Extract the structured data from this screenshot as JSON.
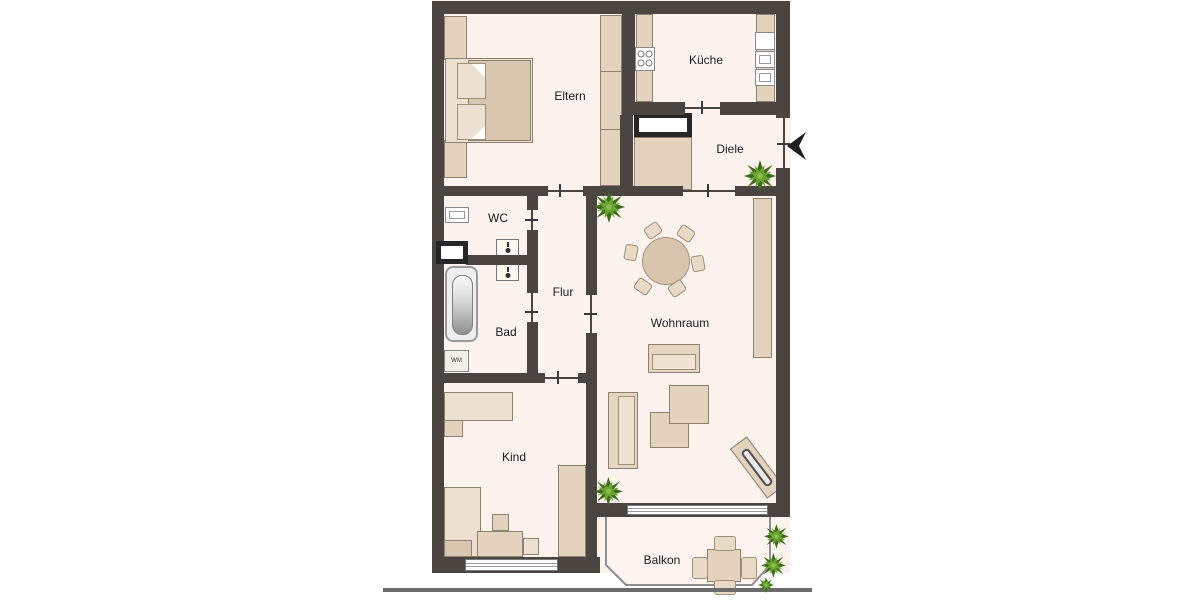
{
  "plan": {
    "type": "apartment-floor-plan",
    "rooms": [
      {
        "id": "eltern",
        "label": "Eltern"
      },
      {
        "id": "kueche",
        "label": "Küche"
      },
      {
        "id": "diele",
        "label": "Diele"
      },
      {
        "id": "wc",
        "label": "WC"
      },
      {
        "id": "bad",
        "label": "Bad"
      },
      {
        "id": "flur",
        "label": "Flur"
      },
      {
        "id": "wohnraum",
        "label": "Wohnraum"
      },
      {
        "id": "kind",
        "label": "Kind"
      },
      {
        "id": "balkon",
        "label": "Balkon"
      }
    ],
    "appliance_labels": {
      "washing_machine": "WM"
    },
    "colors": {
      "wall": "#4a4541",
      "room_fill": "#fcf3ef",
      "furniture": "#e3d3bd",
      "furniture_border": "#8f8170",
      "plant_light": "#6aa331",
      "plant_dark": "#3c6b1a",
      "ground_line": "#6b6b6b"
    }
  }
}
